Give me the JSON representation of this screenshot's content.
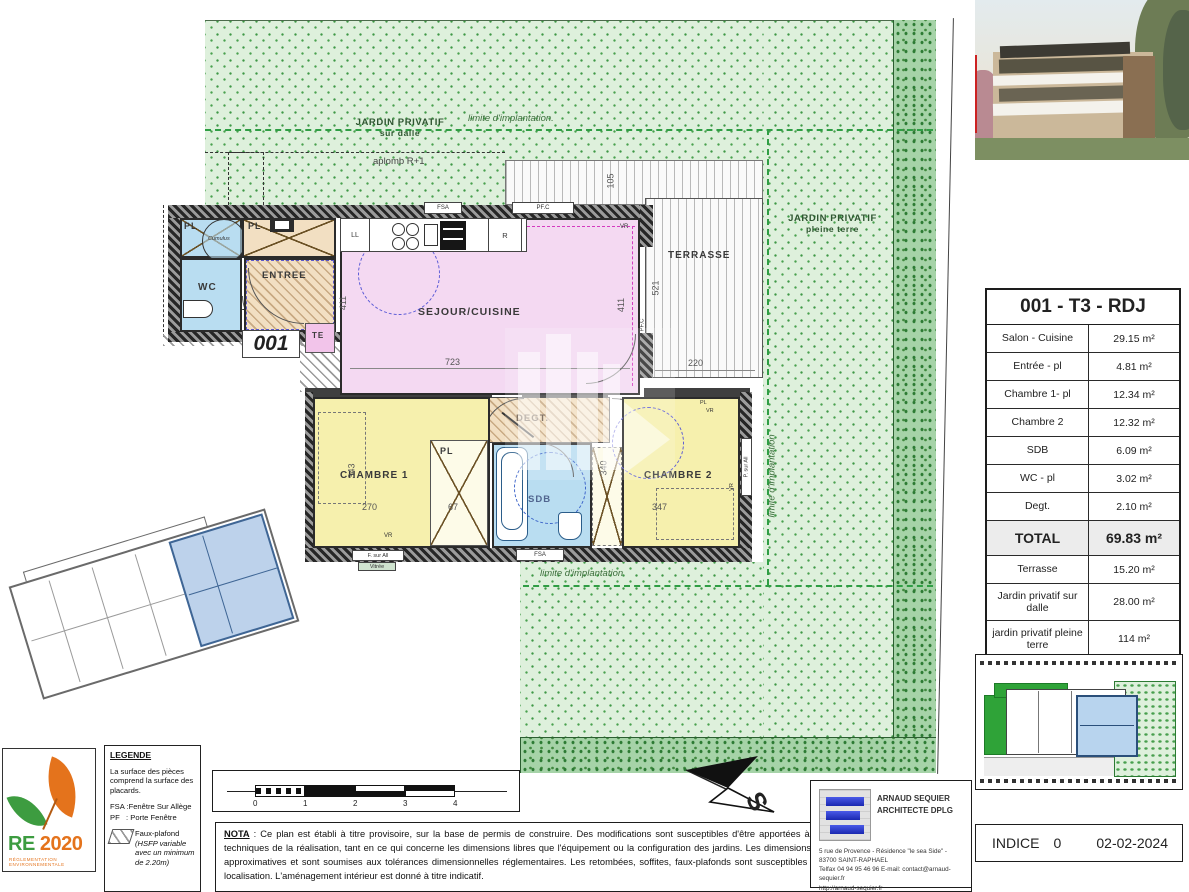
{
  "plan": {
    "unit_number": "001",
    "jardin_dalle": {
      "line1": "JARDIN PRIVATIF",
      "line2": "sur dalle"
    },
    "jardin_terre": {
      "line1": "JARDIN PRIVATIF",
      "line2": "pleine terre"
    },
    "limite_top": "limite d'implantation.",
    "limite_right": "limite d'implantation",
    "limite_bottom": "limite d'implantation",
    "aplomb": "aplomb R+1",
    "rooms": {
      "sejour": "SEJOUR/CUISINE",
      "entree": "ENTREE",
      "wc": "WC",
      "sdb": "SDB",
      "degt": "DEGT.",
      "chambre1": "CHAMBRE 1",
      "chambre2": "CHAMBRE 2",
      "terrasse": "TERRASSE",
      "te": "TE",
      "pl": "PL",
      "cumulus": "Cumulus",
      "ll": "LL",
      "r": "R"
    },
    "openings": {
      "fsa": "FSA",
      "pfc": "PF.C",
      "vr": "VR",
      "f_sur_all": "F. sur All",
      "vitree": "Vitrée",
      "p_sur_all": "P. sur All"
    },
    "dims": {
      "d105": "105",
      "d521": "521",
      "d411a": "411",
      "d411b": "411",
      "d723": "723",
      "d220": "220",
      "d343": "343",
      "d270": "270",
      "d67": "67",
      "d340": "340",
      "d347": "347"
    }
  },
  "unit_table": {
    "title": "001 - T3 - RDJ",
    "rows": [
      {
        "label": "Salon - Cuisine",
        "value": "29.15 m²"
      },
      {
        "label": "Entrée - pl",
        "value": "4.81 m²"
      },
      {
        "label": "Chambre 1- pl",
        "value": "12.34 m²"
      },
      {
        "label": "Chambre 2",
        "value": "12.32 m²"
      },
      {
        "label": "SDB",
        "value": "6.09 m²"
      },
      {
        "label": "WC - pl",
        "value": "3.02 m²"
      },
      {
        "label": "Degt.",
        "value": "2.10 m²"
      },
      {
        "label": "TOTAL",
        "value": "69.83 m²"
      },
      {
        "label": "Terrasse",
        "value": "15.20 m²"
      },
      {
        "label": "Jardin privatif sur dalle",
        "value": "28.00 m²"
      },
      {
        "label": "jardin privatif pleine terre",
        "value": "114 m²"
      }
    ]
  },
  "legend": {
    "title": "LEGENDE",
    "p1": "La surface des pièces comprend la surface des placards.",
    "fsa": "FSA :Fenêtre Sur Allège",
    "pf": "PF   : Porte Fenêtre",
    "faux": "Faux-plafond",
    "faux_note": "(HSFP variable avec un minimum de 2.20m)"
  },
  "re2020": {
    "re": "RE",
    "year": "2020",
    "caption": "RÉGLEMENTATION ENVIRONNEMENTALE"
  },
  "scalebar": {
    "ticks": [
      "0",
      "1",
      "2",
      "3",
      "4"
    ]
  },
  "nota": {
    "label": "NOTA",
    "body": " : Ce plan est établi à titre provisoire, sur la base de permis de construire. Des modifications sont susceptibles d'être apportées à ce plan en fonction des nécessités techniques de la réalisation, tant en ce qui concerne les dimensions libres que l'équipement ou la configuration des jardins. Les dimensions, hauteurs, largeurs et surfaces sont approximatives et sont soumises aux tolérances dimensionnelles réglementaires. Les retombées, soffites, faux-plafonds sont susceptibles d'évoluer en nombre, dimensions et localisation. L'aménagement intérieur est donné à titre indicatif."
  },
  "compass": {
    "south": "S"
  },
  "architect": {
    "name1": "ARNAUD SEQUIER",
    "name2": "ARCHITECTE DPLG",
    "addr1": "5 rue de Provence - Résidence \"le sea Side\" -",
    "addr2": "83700 SAINT-RAPHAEL",
    "addr3": "Telfax 04 94 95 46 96  E-mail: contact@arnaud-sequier.fr",
    "addr4": "http://arnaud-sequier.fr"
  },
  "revision": {
    "label": "INDICE",
    "value": "0",
    "date": "02-02-2024"
  },
  "colors": {
    "grass": "#def0dc",
    "grass_mark": "#4aa14f",
    "hedge": "#a6d3a8",
    "sejour": "#f4d9f2",
    "chambre": "#f6f0ad",
    "wet_room": "#b9ddf1",
    "entree": "#f2dfc2",
    "te": "#f2c4ea",
    "limite_dash": "#2f9e44",
    "logo_green": "#3d9c40",
    "logo_orange": "#e4731c",
    "arch_blue": "#2538d8",
    "keyplan_unit": "#b8d4ee"
  }
}
